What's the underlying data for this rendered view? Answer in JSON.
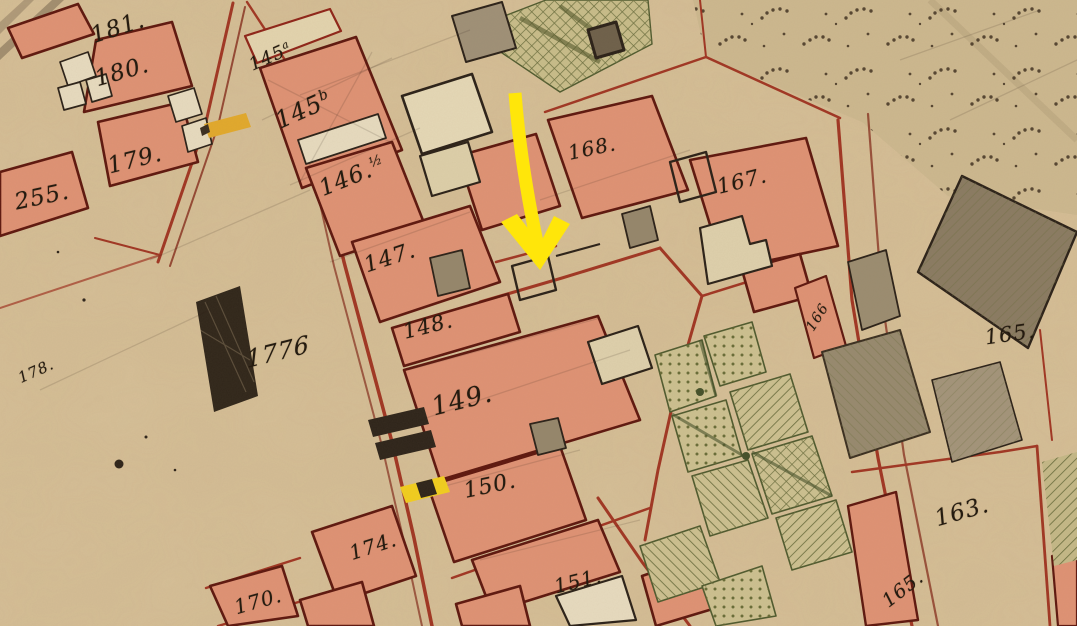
{
  "map": {
    "kind": "historical cadastral map crop",
    "parcels": [
      {
        "id": "181",
        "text": "181."
      },
      {
        "id": "180",
        "text": "180."
      },
      {
        "id": "179",
        "text": "179."
      },
      {
        "id": "255",
        "text": "255."
      },
      {
        "id": "178",
        "text": "178."
      },
      {
        "id": "145a",
        "text": "145",
        "sup": "a"
      },
      {
        "id": "145b",
        "text": "145",
        "sup": "b"
      },
      {
        "id": "146",
        "text": "146.",
        "sup": "½"
      },
      {
        "id": "147",
        "text": "147."
      },
      {
        "id": "148",
        "text": "148."
      },
      {
        "id": "149",
        "text": "149."
      },
      {
        "id": "150",
        "text": "150."
      },
      {
        "id": "151",
        "text": "151."
      },
      {
        "id": "174",
        "text": "174."
      },
      {
        "id": "170",
        "text": "170."
      },
      {
        "id": "168",
        "text": "168."
      },
      {
        "id": "167",
        "text": "167."
      },
      {
        "id": "166",
        "text": "166"
      },
      {
        "id": "165",
        "text": "165."
      },
      {
        "id": "163",
        "text": "163."
      },
      {
        "id": "165b",
        "text": "165."
      },
      {
        "id": "1776",
        "text": "1776"
      }
    ],
    "annotation": {
      "arrow": {
        "shape": "arrow-down",
        "color": "#ffe60a"
      }
    },
    "colors": {
      "paper": "#d6bf97",
      "building_fill": "#df9274",
      "building_outline": "#5e170e",
      "courtyard_fill": "#e7dbbf",
      "road_red": "#9c2a1a",
      "ink": "#2b2118",
      "gray_building": "#95866b",
      "garden_green": "#6f7240",
      "field_stipple": "#483826",
      "highlight_yellow": "#ffe60a",
      "marker_gold": "#e2a92c"
    }
  }
}
